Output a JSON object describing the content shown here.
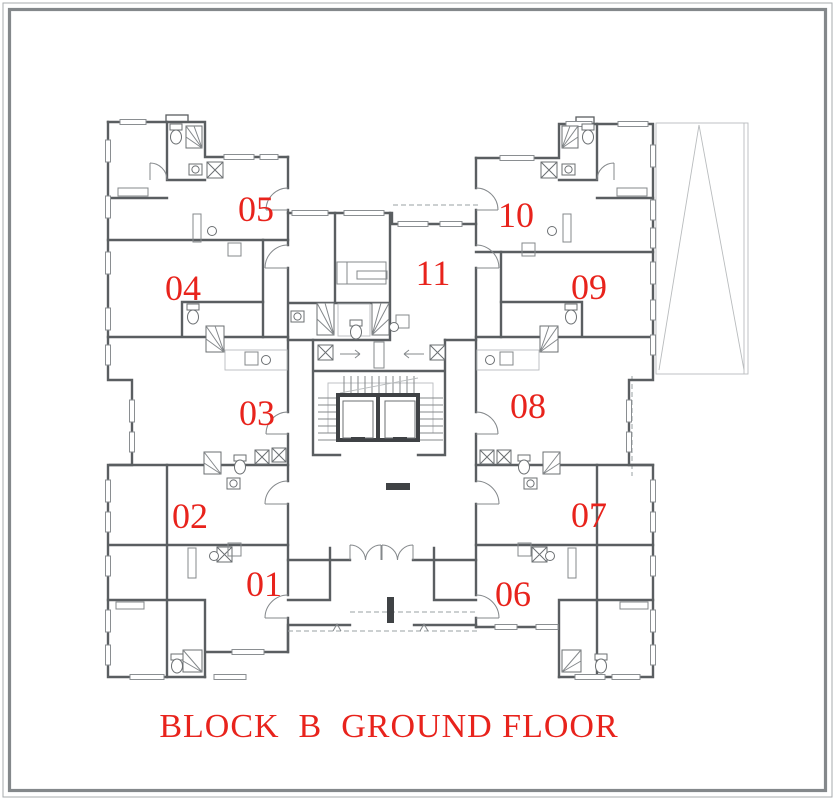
{
  "title": {
    "text": "BLOCK  B  GROUND FLOOR"
  },
  "units": [
    {
      "id": "01",
      "label": "01"
    },
    {
      "id": "02",
      "label": "02"
    },
    {
      "id": "03",
      "label": "03"
    },
    {
      "id": "04",
      "label": "04"
    },
    {
      "id": "05",
      "label": "05"
    },
    {
      "id": "06",
      "label": "06"
    },
    {
      "id": "07",
      "label": "07"
    },
    {
      "id": "08",
      "label": "08"
    },
    {
      "id": "09",
      "label": "09"
    },
    {
      "id": "10",
      "label": "10"
    },
    {
      "id": "11",
      "label": "11"
    }
  ],
  "colors": {
    "accent_red": "#e8231c",
    "wall_gray": "#5a5e61",
    "light_gray": "#b9bcbe",
    "dark_fill": "#3f4245",
    "background": "#ffffff"
  }
}
